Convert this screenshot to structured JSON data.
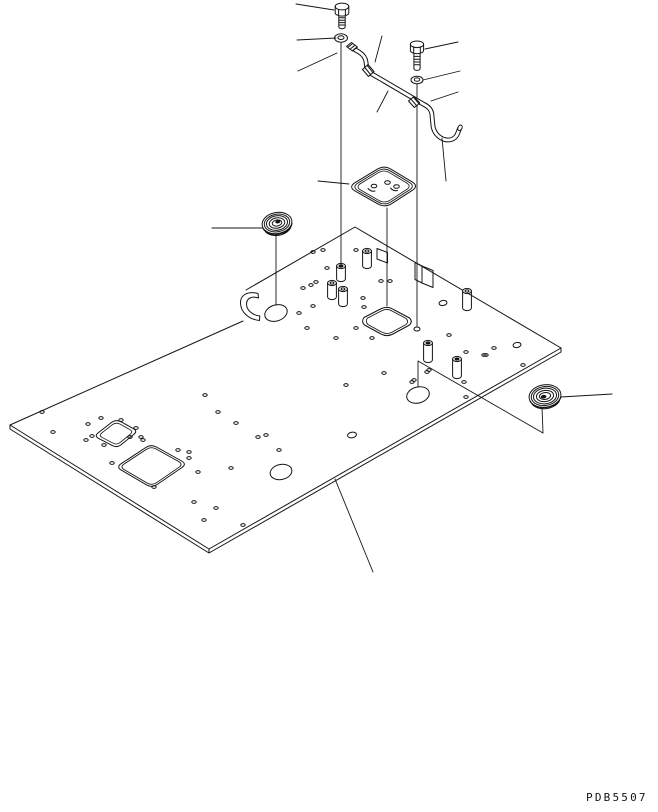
{
  "drawing": {
    "code": "PDB5507",
    "background": "#ffffff",
    "line_color": "#141414",
    "type": "exploded-parts-line-drawing",
    "parts": [
      {
        "name": "hex-bolt-upper"
      },
      {
        "name": "flat-washer-upper"
      },
      {
        "name": "rod-end-clevis"
      },
      {
        "name": "rod-clamp-upper"
      },
      {
        "name": "bent-control-rod"
      },
      {
        "name": "hex-bolt-lower"
      },
      {
        "name": "flat-washer-lower"
      },
      {
        "name": "rod-clamp-lower"
      },
      {
        "name": "access-cover"
      },
      {
        "name": "grommet-left"
      },
      {
        "name": "grommet-right"
      },
      {
        "name": "floor-plate"
      }
    ]
  },
  "plate": {
    "holes": [
      [
        42,
        412
      ],
      [
        53,
        432
      ],
      [
        88,
        424
      ],
      [
        101,
        418
      ],
      [
        121,
        420
      ],
      [
        136,
        428
      ],
      [
        86,
        440
      ],
      [
        92,
        436
      ],
      [
        104,
        445
      ],
      [
        130,
        437
      ],
      [
        141,
        437
      ],
      [
        112,
        463
      ],
      [
        143,
        440
      ],
      [
        178,
        450
      ],
      [
        189,
        458
      ],
      [
        198,
        472
      ],
      [
        154,
        487
      ],
      [
        205,
        395
      ],
      [
        218,
        412
      ],
      [
        236,
        423
      ],
      [
        231,
        468
      ],
      [
        194,
        502
      ],
      [
        216,
        508
      ],
      [
        204,
        520
      ],
      [
        243,
        525
      ],
      [
        266,
        435
      ],
      [
        258,
        437
      ],
      [
        279,
        450
      ],
      [
        189,
        452
      ],
      [
        313,
        252
      ],
      [
        323,
        250
      ],
      [
        327,
        268
      ],
      [
        316,
        282
      ],
      [
        303,
        288
      ],
      [
        311,
        285
      ],
      [
        313,
        306
      ],
      [
        299,
        313
      ],
      [
        363,
        298
      ],
      [
        364,
        307
      ],
      [
        356,
        328
      ],
      [
        372,
        338
      ],
      [
        336,
        338
      ],
      [
        346,
        385
      ],
      [
        384,
        373
      ],
      [
        412,
        382
      ],
      [
        427,
        372
      ],
      [
        449,
        335
      ],
      [
        466,
        352
      ],
      [
        484,
        355
      ],
      [
        464,
        382
      ],
      [
        429,
        370
      ],
      [
        414,
        380
      ],
      [
        466,
        397
      ],
      [
        494,
        348
      ],
      [
        486,
        355
      ],
      [
        523,
        365
      ],
      [
        356,
        250
      ],
      [
        381,
        281
      ],
      [
        390,
        281
      ],
      [
        307,
        328
      ]
    ],
    "bosses": [
      [
        367,
        251,
        15,
        0
      ],
      [
        341,
        266,
        13,
        1
      ],
      [
        332,
        283,
        14,
        0
      ],
      [
        343,
        289,
        15,
        0
      ],
      [
        467,
        291,
        17,
        0
      ],
      [
        428,
        343,
        17,
        1
      ],
      [
        457,
        359,
        17,
        1
      ]
    ],
    "oval_holes": [
      [
        276,
        313,
        11.5,
        8,
        -18
      ],
      [
        418,
        395,
        11.5,
        8,
        -15
      ],
      [
        281,
        472,
        11,
        7.5,
        -12
      ],
      [
        352,
        435,
        4.5,
        2.8,
        -10
      ],
      [
        443,
        303,
        4,
        2.5,
        -10
      ],
      [
        517,
        345,
        4,
        2.5,
        -10
      ],
      [
        417,
        329,
        3,
        2,
        0
      ]
    ]
  },
  "leader_lines": [
    [
      [
        296,
        4
      ],
      [
        334,
        10
      ]
    ],
    [
      [
        297,
        40
      ],
      [
        336,
        38
      ]
    ],
    [
      [
        298,
        71
      ],
      [
        337,
        53
      ]
    ],
    [
      [
        382,
        36
      ],
      [
        375,
        62
      ]
    ],
    [
      [
        377,
        112
      ],
      [
        388,
        91
      ]
    ],
    [
      [
        458,
        42
      ],
      [
        425,
        49
      ]
    ],
    [
      [
        460,
        71
      ],
      [
        423,
        80
      ]
    ],
    [
      [
        458,
        92
      ],
      [
        431,
        101
      ]
    ],
    [
      [
        442,
        138
      ],
      [
        446,
        181
      ]
    ],
    [
      [
        318,
        181
      ],
      [
        349,
        184
      ]
    ],
    [
      [
        212,
        228
      ],
      [
        262,
        228
      ]
    ],
    [
      [
        561,
        397
      ],
      [
        612,
        394
      ]
    ],
    [
      [
        335,
        479
      ],
      [
        373,
        572
      ]
    ]
  ],
  "assembly_lines": [
    [
      [
        341,
        43
      ],
      [
        341,
        265
      ]
    ],
    [
      [
        387,
        208
      ],
      [
        387,
        306
      ]
    ],
    [
      [
        417,
        84
      ],
      [
        417,
        326
      ]
    ],
    [
      [
        276,
        235
      ],
      [
        276,
        305
      ]
    ],
    [
      [
        542,
        407
      ],
      [
        543,
        433
      ],
      [
        418,
        361
      ],
      [
        418,
        387
      ]
    ]
  ]
}
